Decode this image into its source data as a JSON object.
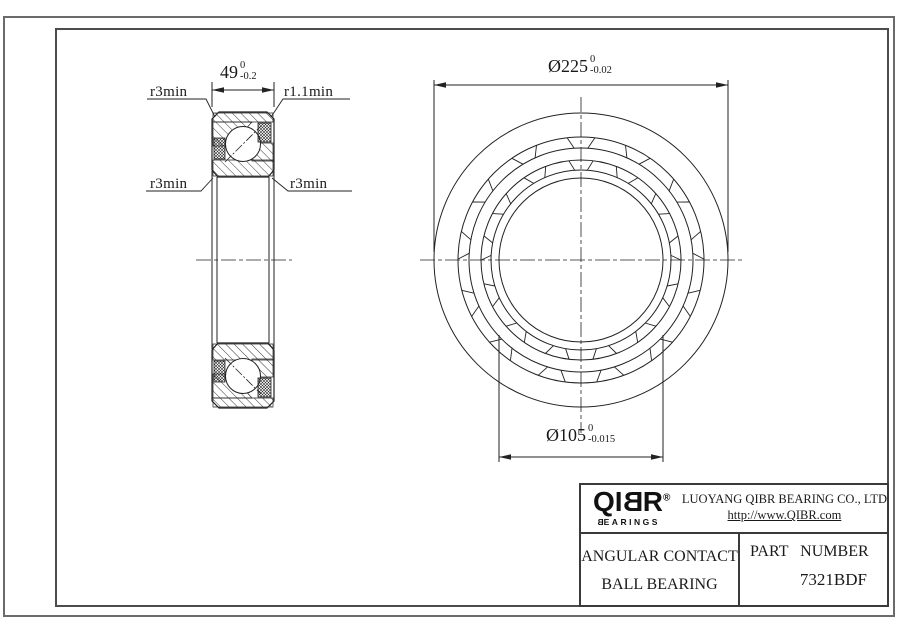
{
  "drawing": {
    "section_view": {
      "width_dim": {
        "value": "49",
        "tol_upper": "0",
        "tol_lower": "-0.2"
      },
      "corner_labels": {
        "top_left": "r3min",
        "top_right": "r1.1min",
        "mid_left": "r3min",
        "mid_right": "r3min"
      }
    },
    "front_view": {
      "outer_diameter_dim": {
        "value": "Ø225",
        "tol_upper": "0",
        "tol_lower": "-0.02"
      },
      "bore_diameter_dim": {
        "value": "Ø105",
        "tol_upper": "0",
        "tol_lower": "-0.015"
      }
    }
  },
  "title_block": {
    "logo": {
      "prefix": "QI",
      "mirrored_letter": "B",
      "suffix": "R",
      "registered_mark": "®",
      "subtext_mirrored_letter": "B",
      "subtext_rest": "EARINGS"
    },
    "company_name": "LUOYANG QIBR BEARING CO., LTD",
    "website": "http://www.QIBR.com",
    "product_type_line1": "ANGULAR CONTACT",
    "product_type_line2": "BALL BEARING",
    "part_number_label": "PART NUMBER",
    "part_number": "7321BDF"
  },
  "colors": {
    "line_color": "#222222",
    "frame_color": "#555555",
    "background": "#ffffff"
  }
}
